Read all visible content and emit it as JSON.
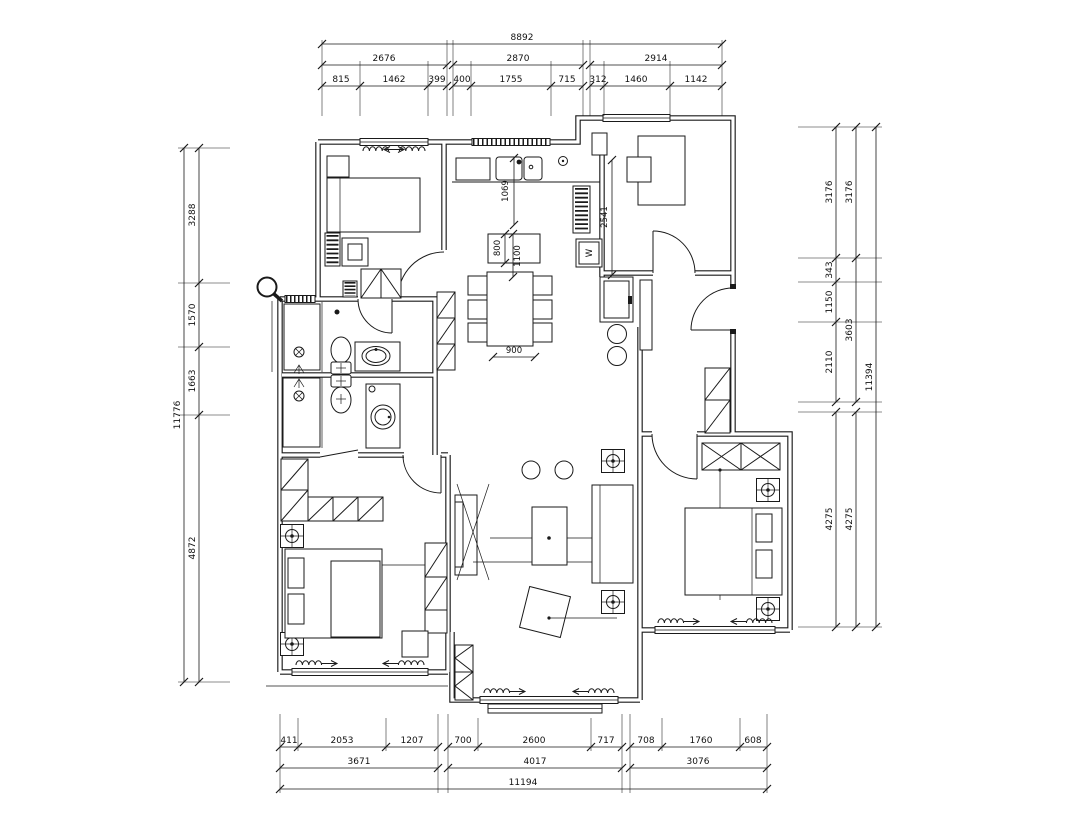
{
  "drawing": {
    "type": "apartment-floor-plan"
  },
  "colors": {
    "line": "#1a1a1a",
    "background": "#ffffff"
  },
  "dims": {
    "top": {
      "overall": "8892",
      "row2": [
        "2676",
        "2870",
        "2914"
      ],
      "row3": [
        "815",
        "1462",
        "399",
        "400",
        "1755",
        "715",
        "312",
        "1460",
        "1142"
      ]
    },
    "bottom": {
      "row1": [
        "411",
        "2053",
        "1207",
        "700",
        "2600",
        "717",
        "708",
        "1760",
        "608"
      ],
      "row2": [
        "3671",
        "4017",
        "3076"
      ],
      "overall": "11194"
    },
    "left": {
      "overall": "11776",
      "segments": [
        "3288",
        "1570",
        "1663",
        "4872"
      ]
    },
    "right": {
      "inner": [
        "3176",
        "343",
        "1150",
        "2110",
        "4275"
      ],
      "middle": [
        "3176",
        "3603",
        "4275"
      ],
      "overall": "11394"
    },
    "interior": {
      "counter_depth": "1069",
      "island_w": "800",
      "island_l": "1100",
      "kitchen_length": "2541",
      "table_w": "900",
      "washer": "W"
    }
  }
}
